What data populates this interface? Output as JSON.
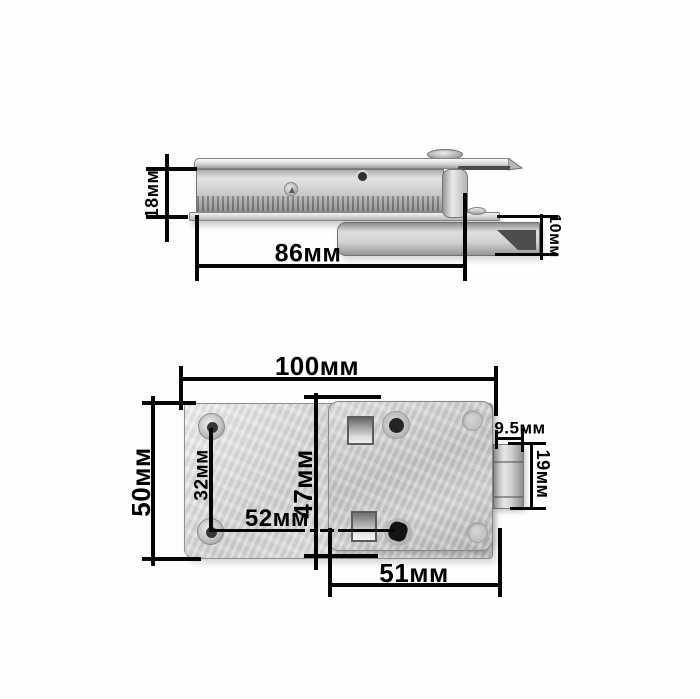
{
  "title": "Latch lock hardware dimension diagram",
  "unit": "мм",
  "side_view": {
    "label": "side profile view",
    "dims": {
      "body_height": "18мм",
      "body_length": "86мм",
      "latch_thickness": "10мм"
    }
  },
  "plan_view": {
    "label": "back plan view",
    "dims": {
      "overall_width": "100мм",
      "overall_height": "50мм",
      "mount_hole_spacing": "32мм",
      "lock_body_height": "47мм",
      "hole_to_screw": "52мм",
      "lock_body_width": "51мм",
      "bolt_width": "9.5мм",
      "bolt_height": "19мм"
    }
  }
}
